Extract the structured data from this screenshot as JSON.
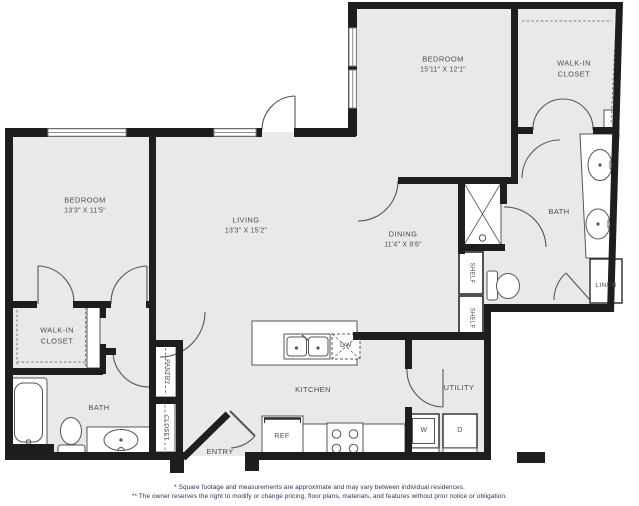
{
  "colors": {
    "background": "#ffffff",
    "floor_fill": "#e9e9e9",
    "wall": "#1e1e21",
    "thin_line": "#54555b",
    "label_text": "#4b4c52",
    "footnote_text": "#263257"
  },
  "rooms": {
    "bedroom2_name": "BEDROOM",
    "bedroom2_dims": "15'11\" X 12'1\"",
    "closet2_line1": "WALK-IN",
    "closet2_line2": "CLOSET",
    "bath2": "BATH",
    "linen": "LINEN",
    "bedroom1_name": "BEDROOM",
    "bedroom1_dims": "13'3\" X 11'5\"",
    "living_name": "LIVING",
    "living_dims": "13'3\" X 15'2\"",
    "dining_name": "DINING",
    "dining_dims": "11'4\" X 8'6\"",
    "closet1_line1": "WALK-IN",
    "closet1_line2": "CLOSET",
    "bath1": "BATH",
    "kitchen": "KITCHEN",
    "utility": "UTILITY",
    "entry": "ENTRY",
    "pantry": "PANTRY",
    "closet_small": "CLOSET",
    "shelf_upper": "SHELF",
    "shelf_lower": "SHELF"
  },
  "appliances": {
    "refrigerator": "REF",
    "dishwasher": "DW",
    "washer": "W",
    "dryer": "D"
  },
  "footnotes": {
    "line1": "* Square footage and measurements are approximate and may vary between individual residences.",
    "line2": "** The owner reserves the right to modify or change pricing, floor plans, materials, and features without prior notice or obligation."
  }
}
